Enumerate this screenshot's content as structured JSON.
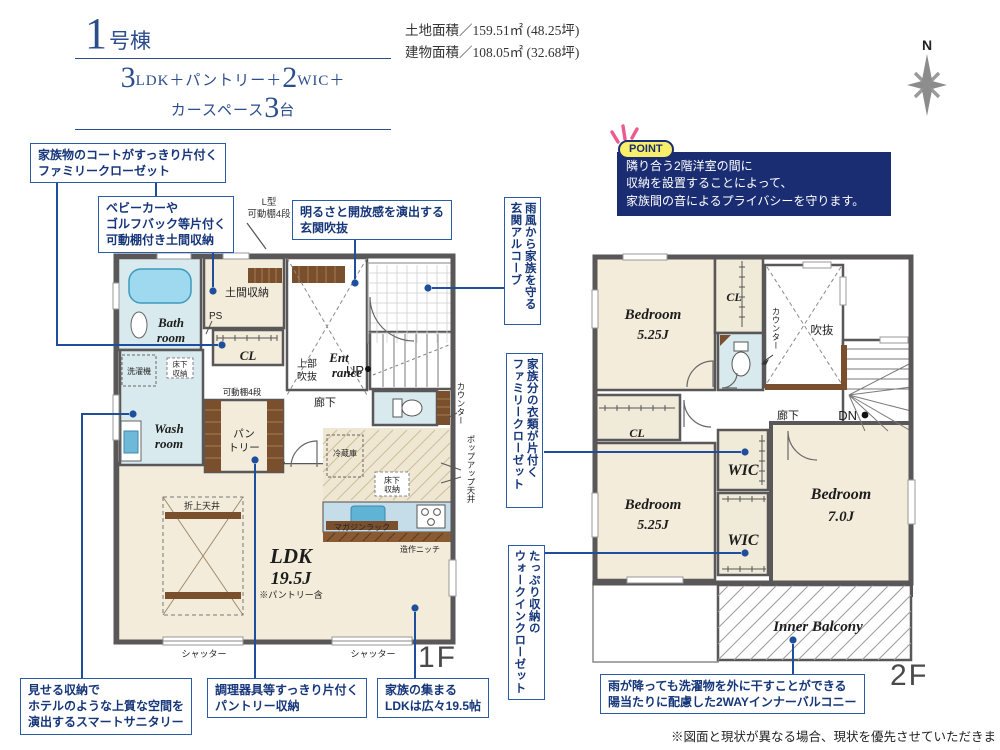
{
  "header": {
    "building_no": "1",
    "building_suffix": "号棟",
    "plan": {
      "num1": "3",
      "part1": "LDK＋パントリー＋",
      "num2": "2",
      "part2": "WIC＋",
      "part3": "カースペース",
      "num3": "3",
      "part4": "台"
    },
    "land_area": "土地面積／159.51㎡ (48.25坪)",
    "building_area": "建物面積／108.05㎡ (32.68坪)",
    "compass_n": "N"
  },
  "point": {
    "badge": "POINT",
    "lines": [
      "隣り合う2階洋室の間に",
      "収納を設置することによって、",
      "家族間の音によるプライバシーを守ります。"
    ]
  },
  "callouts": {
    "family_closet_1f": [
      "家族物のコートがすっきり片付く",
      "ファミリークローゼット"
    ],
    "doma_storage": [
      "ベビーカーや",
      "ゴルフバック等片付く",
      "可動棚付き土間収納"
    ],
    "genkan_fukinuke": [
      "明るさと開放感を演出する",
      "玄関吹抜"
    ],
    "genkan_alcove": [
      "雨風から家族を守る",
      "玄関アルコーブ"
    ],
    "family_closet_2f": [
      "家族分の衣類が片付く",
      "ファミリークローゼット"
    ],
    "wic_2f": [
      "たっぷり収納の",
      "ウォークインクローゼット"
    ],
    "smart_sanitary": [
      "見せる収納で",
      "ホテルのような上質な空間を",
      "演出するスマートサニタリー"
    ],
    "pantry_storage": [
      "調理器具等すっきり片付く",
      "パントリー収納"
    ],
    "ldk_gather": [
      "家族の集まる",
      "LDKは広々19.5帖"
    ],
    "inner_balcony": [
      "雨が降っても洗濯物を外に干すことができる",
      "陽当たりに配慮した2WAYインナーバルコニー"
    ]
  },
  "lgata": [
    "L型",
    "可動棚4段"
  ],
  "floor1": {
    "label": "1F",
    "bath": [
      "Bath",
      "room"
    ],
    "wash": [
      "Wash",
      "room"
    ],
    "doma": "土間収納",
    "ps": "PS",
    "cl": "CL",
    "washer": "洗濯機",
    "underfloor1": [
      "床下",
      "収納"
    ],
    "shelf4": "可動棚4段",
    "pantry": [
      "パン",
      "トリー"
    ],
    "void_upper": [
      "上部",
      "吹抜"
    ],
    "entrance": [
      "Ent",
      "rance"
    ],
    "hallway": "廊下",
    "up": "UP",
    "counter": "カウンター",
    "popup_ceiling": "ポップアップ天井",
    "coffered": "折上天井",
    "ldk": [
      "LDK",
      "19.5J"
    ],
    "ldk_note": "※パントリー含",
    "fridge": "冷蔵庫",
    "underfloor2": [
      "床下",
      "収納"
    ],
    "magazine": "マガジンラック",
    "niche": "造作ニッチ",
    "shutter": "シャッター"
  },
  "floor2": {
    "label": "2F",
    "bedroom1": [
      "Bedroom",
      "5.25J"
    ],
    "cl1": "CL",
    "counter": "カウンター",
    "void": "吹抜",
    "hallway": "廊下",
    "dn": "DN",
    "cl2": "CL",
    "bedroom2": [
      "Bedroom",
      "5.25J"
    ],
    "wic1": "WIC",
    "wic2": "WIC",
    "bedroom3": [
      "Bedroom",
      "7.0J"
    ],
    "balcony": "Inner Balcony"
  },
  "footer": {
    "disclaimer": "※図面と現状が異なる場合、現状を優先させていただきます。"
  }
}
